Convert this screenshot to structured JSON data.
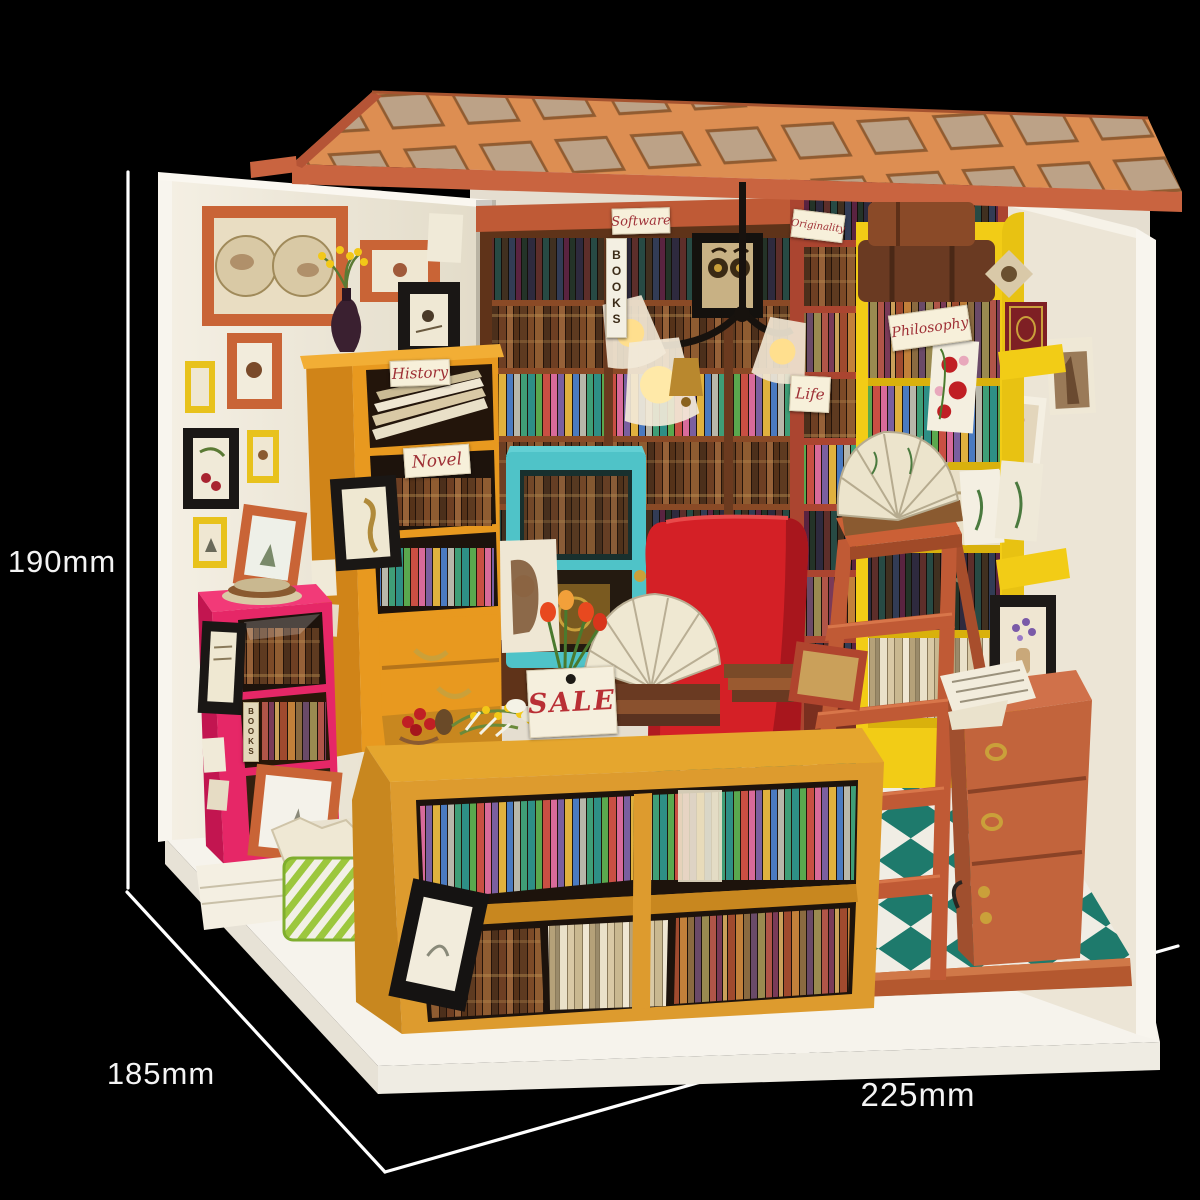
{
  "annotations": {
    "height": "190mm",
    "depth": "185mm",
    "width": "225mm"
  },
  "signs": {
    "history": "History",
    "novel": "Novel",
    "software": "Software",
    "originality": "Originality",
    "philosophy": "Philosophy",
    "life": "Life",
    "sale": "SALE",
    "books_spine_center": "BOOKS",
    "books_spine_pink": "BOOKS"
  },
  "colors": {
    "background": "#000000",
    "dimension_line": "#ffffff",
    "base_platform": "#f6f3ec",
    "floor_trim": "#b4582f",
    "roof_lattice": "#dd8e52",
    "roof_beam": "#c96440",
    "wall_cream": "#efe9dc",
    "floor_teal": "#1e7a6c",
    "floor_white": "#f0ede4",
    "bookshelf_amber": "#e8991f",
    "display_case_amber": "#dd9b2e",
    "bookcase_pink": "#e62767",
    "bookshelf_yellow": "#f2cc16",
    "bookshelf_red": "#ab4530",
    "ladder_terracotta": "#c05a35",
    "armchair_red": "#d42026",
    "cabinet_teal": "#4fc3c8",
    "nightstand_terracotta": "#c2643c",
    "sign_text_red": "#9e2f35",
    "brass": "#caa03a"
  }
}
